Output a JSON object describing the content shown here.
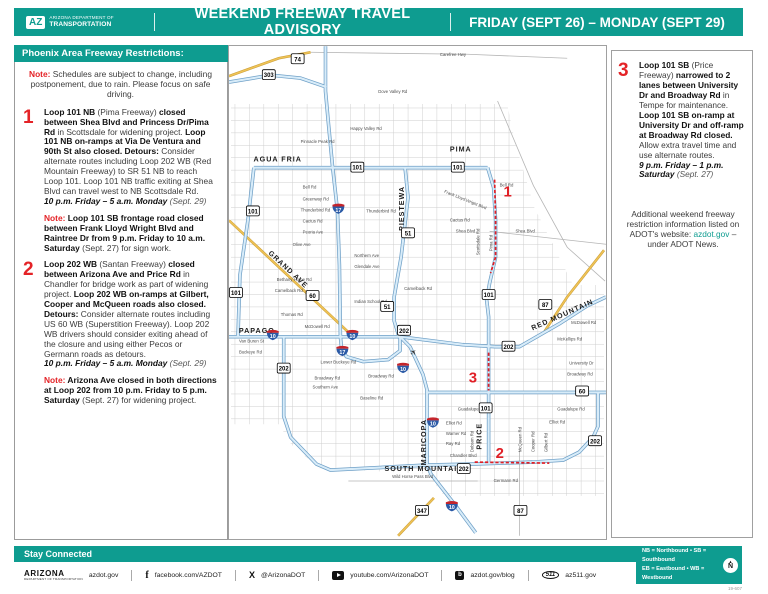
{
  "colors": {
    "teal": "#0E9C90",
    "red": "#E42327",
    "marker_red": "#E01F26",
    "freeway_blue": "#6FA0C7",
    "freeway_fill": "#D8ECF9",
    "highway_yellow": "#EFC356",
    "interstate_blue": "#2B5AA6",
    "interstate_red": "#C3242B"
  },
  "header": {
    "logo_mark": "AZ",
    "logo_line1": "ARIZONA DEPARTMENT OF",
    "logo_line2": "TRANSPORTATION",
    "title": "WEEKEND FREEWAY TRAVEL ADVISORY",
    "date_range": "FRIDAY (SEPT 26) – MONDAY (SEPT 29)"
  },
  "sidebar": {
    "title": "Phoenix Area Freeway Restrictions:",
    "intro": [
      {
        "s": "red",
        "t": "Note: "
      },
      {
        "s": "n",
        "t": "Schedules are subject to change, including postponement, due to rain. Please focus on safe driving."
      }
    ],
    "items": [
      {
        "num": "1",
        "runs": [
          {
            "s": "b",
            "t": "Loop 101 NB "
          },
          {
            "s": "n",
            "t": "(Pima Freeway) "
          },
          {
            "s": "b",
            "t": "closed between Shea Blvd and Princess Dr/Pima Rd "
          },
          {
            "s": "n",
            "t": "in Scottsdale for widening project. "
          },
          {
            "s": "b",
            "t": "Loop 101 NB on-ramps at Via De Ventura and 90th St also closed. "
          },
          {
            "s": "b",
            "t": "Detours: "
          },
          {
            "s": "n",
            "t": "Consider alternate routes including Loop 202 WB (Red Mountain Freeway) to SR 51 NB to reach Loop 101. Loop 101 NB traffic exiting at Shea Blvd can travel west to NB Scottsdale Rd. "
          },
          {
            "br": true
          },
          {
            "s": "bi",
            "t": "10 p.m. Friday – 5 a.m. Monday "
          },
          {
            "s": "i",
            "t": "(Sept. 29)"
          }
        ],
        "note": [
          {
            "s": "red",
            "t": "Note: "
          },
          {
            "s": "b",
            "t": "Loop 101 SB frontage road closed between Frank Lloyd Wright Blvd and Raintree Dr from 9 p.m. Friday to 10 a.m. Saturday "
          },
          {
            "s": "n",
            "t": "(Sept. 27) for sign work."
          }
        ]
      },
      {
        "num": "2",
        "runs": [
          {
            "s": "b",
            "t": "Loop 202 WB "
          },
          {
            "s": "n",
            "t": "(Santan Freeway) "
          },
          {
            "s": "b",
            "t": "closed between Arizona Ave and Price Rd "
          },
          {
            "s": "n",
            "t": "in Chandler for bridge work as part of widening project. "
          },
          {
            "s": "b",
            "t": "Loop 202 WB on-ramps at Gilbert, Cooper and McQueen roads also closed. "
          },
          {
            "s": "b",
            "t": "Detours: "
          },
          {
            "s": "n",
            "t": "Consider alternate routes including US 60 WB (Superstition Freeway). Loop 202 WB drivers should consider exiting ahead of the closure and using either Pecos or Germann roads as detours. "
          },
          {
            "br": true
          },
          {
            "s": "bi",
            "t": "10 p.m. Friday – 5 a.m. Monday "
          },
          {
            "s": "i",
            "t": "(Sept. 29)"
          }
        ],
        "note": [
          {
            "s": "red",
            "t": "Note: "
          },
          {
            "s": "b",
            "t": "Arizona Ave closed in both directions at Loop 202 from 10 p.m. Friday to 5 p.m. Saturday "
          },
          {
            "s": "n",
            "t": "(Sept. 27) for widening project."
          }
        ]
      }
    ]
  },
  "right_panel": {
    "item": {
      "num": "3",
      "runs": [
        {
          "s": "b",
          "t": "Loop 101 SB "
        },
        {
          "s": "n",
          "t": "(Price Freeway) "
        },
        {
          "s": "b",
          "t": "narrowed to 2 lanes between University Dr and Broadway Rd "
        },
        {
          "s": "n",
          "t": "in Tempe for maintenance. "
        },
        {
          "s": "b",
          "t": "Loop 101 SB on-ramp at University Dr and off-ramp at Broadway Rd closed. "
        },
        {
          "s": "n",
          "t": "Allow extra travel time and use alternate routes. "
        },
        {
          "br": true
        },
        {
          "s": "bi",
          "t": "9 p.m. Friday – 1 p.m. Saturday "
        },
        {
          "s": "i",
          "t": "(Sept. 27)"
        }
      ]
    },
    "additional": [
      {
        "s": "n",
        "t": "Additional weekend freeway restriction information listed on ADOT's website: "
      },
      {
        "s": "teal",
        "t": "azdot.gov"
      },
      {
        "s": "n",
        "t": " – under ADOT News."
      }
    ]
  },
  "map": {
    "region_labels": [
      {
        "t": "AGUA FRIA",
        "x": 49,
        "y": 116
      },
      {
        "t": "PIMA",
        "x": 233,
        "y": 106
      },
      {
        "t": "PIESTEWA",
        "x": 176,
        "y": 163,
        "r": -90
      },
      {
        "t": "GRAND AVE",
        "x": 58,
        "y": 226,
        "r": 43
      },
      {
        "t": "RED MOUNTAIN",
        "x": 336,
        "y": 272,
        "r": -24
      },
      {
        "t": "PAPAGO",
        "x": 28,
        "y": 288
      },
      {
        "t": "MARICOPA",
        "x": 198,
        "y": 398,
        "r": -90
      },
      {
        "t": "PRICE",
        "x": 254,
        "y": 392,
        "r": -90
      },
      {
        "t": "SOUTH MOUNTAIN",
        "x": 196,
        "y": 427
      }
    ],
    "shields": [
      {
        "n": "74",
        "x": 69,
        "y": 13
      },
      {
        "n": "303",
        "x": 40,
        "y": 29
      },
      {
        "n": "101",
        "x": 129,
        "y": 122
      },
      {
        "n": "101",
        "x": 230,
        "y": 122
      },
      {
        "n": "101",
        "x": 24,
        "y": 166
      },
      {
        "n": "101",
        "x": 7,
        "y": 248
      },
      {
        "n": "101",
        "x": 261,
        "y": 250
      },
      {
        "n": "101",
        "x": 258,
        "y": 364
      },
      {
        "n": "51",
        "x": 180,
        "y": 188
      },
      {
        "n": "51",
        "x": 159,
        "y": 262
      },
      {
        "n": "60",
        "x": 84,
        "y": 251
      },
      {
        "n": "60",
        "x": 355,
        "y": 347
      },
      {
        "n": "202",
        "x": 176,
        "y": 286
      },
      {
        "n": "202",
        "x": 281,
        "y": 302
      },
      {
        "n": "202",
        "x": 55,
        "y": 324
      },
      {
        "n": "202",
        "x": 236,
        "y": 425
      },
      {
        "n": "202",
        "x": 368,
        "y": 397
      },
      {
        "n": "87",
        "x": 318,
        "y": 260
      },
      {
        "n": "87",
        "x": 293,
        "y": 467
      },
      {
        "n": "347",
        "x": 194,
        "y": 467
      },
      {
        "n": "10",
        "k": "i",
        "x": 44,
        "y": 290
      },
      {
        "n": "10",
        "k": "i",
        "x": 124,
        "y": 290
      },
      {
        "n": "10",
        "k": "i",
        "x": 175,
        "y": 323
      },
      {
        "n": "10",
        "k": "i",
        "x": 205,
        "y": 378
      },
      {
        "n": "10",
        "k": "i",
        "x": 224,
        "y": 462
      },
      {
        "n": "17",
        "k": "i",
        "x": 110,
        "y": 163
      },
      {
        "n": "17",
        "k": "i",
        "x": 114,
        "y": 306
      }
    ],
    "streets": [
      {
        "t": "Carefree Hwy",
        "x": 212,
        "y": 10
      },
      {
        "t": "Dove Valley Rd",
        "x": 150,
        "y": 47
      },
      {
        "t": "Happy Valley Rd",
        "x": 122,
        "y": 84
      },
      {
        "t": "Pinnacle Peak Rd",
        "x": 72,
        "y": 97
      },
      {
        "t": "Bell Rd",
        "x": 74,
        "y": 143
      },
      {
        "t": "Bell Rd",
        "x": 272,
        "y": 141
      },
      {
        "t": "Frank Lloyd Wright Blvd",
        "x": 216,
        "y": 147,
        "r": 22
      },
      {
        "t": "Greenway Rd",
        "x": 74,
        "y": 155
      },
      {
        "t": "Thunderbird Rd",
        "x": 72,
        "y": 166
      },
      {
        "t": "Thunderbird Rd",
        "x": 138,
        "y": 167
      },
      {
        "t": "Cactus Rd",
        "x": 74,
        "y": 177
      },
      {
        "t": "Cactus Rd",
        "x": 222,
        "y": 176
      },
      {
        "t": "Peoria Ave",
        "x": 74,
        "y": 188
      },
      {
        "t": "Olive Ave",
        "x": 64,
        "y": 201
      },
      {
        "t": "Shea Blvd",
        "x": 228,
        "y": 187
      },
      {
        "t": "Shea Blvd",
        "x": 288,
        "y": 187
      },
      {
        "t": "Northern Ave",
        "x": 126,
        "y": 212
      },
      {
        "t": "Glendale Ave",
        "x": 126,
        "y": 223
      },
      {
        "t": "Bethany Home Rd",
        "x": 48,
        "y": 236
      },
      {
        "t": "Camelback Rd",
        "x": 46,
        "y": 247
      },
      {
        "t": "Camelback Rd",
        "x": 176,
        "y": 245
      },
      {
        "t": "Indian School Rd",
        "x": 126,
        "y": 258
      },
      {
        "t": "Thomas Rd",
        "x": 52,
        "y": 271
      },
      {
        "t": "McDowell Rd",
        "x": 76,
        "y": 283
      },
      {
        "t": "McDowell Rd",
        "x": 344,
        "y": 279
      },
      {
        "t": "Van Buren St",
        "x": 10,
        "y": 298
      },
      {
        "t": "Buckeye Rd",
        "x": 10,
        "y": 309
      },
      {
        "t": "Lower Buckeye Rd",
        "x": 92,
        "y": 319
      },
      {
        "t": "Broadway Rd",
        "x": 86,
        "y": 335
      },
      {
        "t": "Broadway Rd",
        "x": 140,
        "y": 333
      },
      {
        "t": "Broadway Rd",
        "x": 340,
        "y": 331
      },
      {
        "t": "Southern Ave",
        "x": 84,
        "y": 344
      },
      {
        "t": "Baseline Rd",
        "x": 132,
        "y": 355
      },
      {
        "t": "McKellips Rd",
        "x": 330,
        "y": 296
      },
      {
        "t": "University Dr",
        "x": 342,
        "y": 320
      },
      {
        "t": "Guadalupe Rd",
        "x": 230,
        "y": 366
      },
      {
        "t": "Guadalupe Rd",
        "x": 330,
        "y": 366
      },
      {
        "t": "Elliot Rd",
        "x": 218,
        "y": 380
      },
      {
        "t": "Elliot Rd",
        "x": 322,
        "y": 379
      },
      {
        "t": "Warner Rd",
        "x": 218,
        "y": 391
      },
      {
        "t": "Ray Rd",
        "x": 218,
        "y": 401
      },
      {
        "t": "Chandler Blvd",
        "x": 222,
        "y": 413
      },
      {
        "t": "Germann Rd",
        "x": 266,
        "y": 438
      },
      {
        "t": "Wild Horse Pass Blvd",
        "x": 164,
        "y": 434
      },
      {
        "t": "Dobson Rd",
        "x": 246,
        "y": 408,
        "r": -90
      },
      {
        "t": "McQueen Rd",
        "x": 294,
        "y": 408,
        "r": -90
      },
      {
        "t": "Cooper Rd",
        "x": 307,
        "y": 408,
        "r": -90
      },
      {
        "t": "Gilbert Rd",
        "x": 320,
        "y": 408,
        "r": -90
      },
      {
        "t": "Scottsdale Rd",
        "x": 252,
        "y": 210,
        "r": -90
      },
      {
        "t": "Pima Rd",
        "x": 265,
        "y": 206,
        "r": -90
      }
    ],
    "markers": [
      {
        "n": "1",
        "x": 276,
        "y": 151
      },
      {
        "n": "2",
        "x": 268,
        "y": 414
      },
      {
        "n": "3",
        "x": 241,
        "y": 338
      }
    ],
    "closures": [
      "M267,134 L268,174 L268,212 L263,228",
      "M261,308 L261,346",
      "M247,418 L322,419"
    ],
    "airport_glyph": "✈"
  },
  "footer": {
    "stay_connected": "Stay Connected",
    "adot_logo_line1": "ARIZONA",
    "adot_logo_line2": "DEPARTMENT OF TRANSPORTATION",
    "icons": {
      "facebook_glyph": "f",
      "x_glyph": "X",
      "blog_glyph": "b",
      "n511_glyph": "511"
    },
    "links": [
      {
        "label": "azdot.gov"
      },
      {
        "label": "facebook.com/AZDOT"
      },
      {
        "label": "@ArizonaDOT"
      },
      {
        "label": "youtube.com/ArizonaDOT"
      },
      {
        "label": "azdot.gov/blog"
      },
      {
        "label": "az511.gov"
      }
    ],
    "legend_line1": "NB = Northbound  •  SB = Southbound",
    "legend_line2": "EB = Eastbound  •  WB = Westbound",
    "north_arrow_glyph": "▲",
    "north_label": "N",
    "doc_number": "19-607"
  }
}
